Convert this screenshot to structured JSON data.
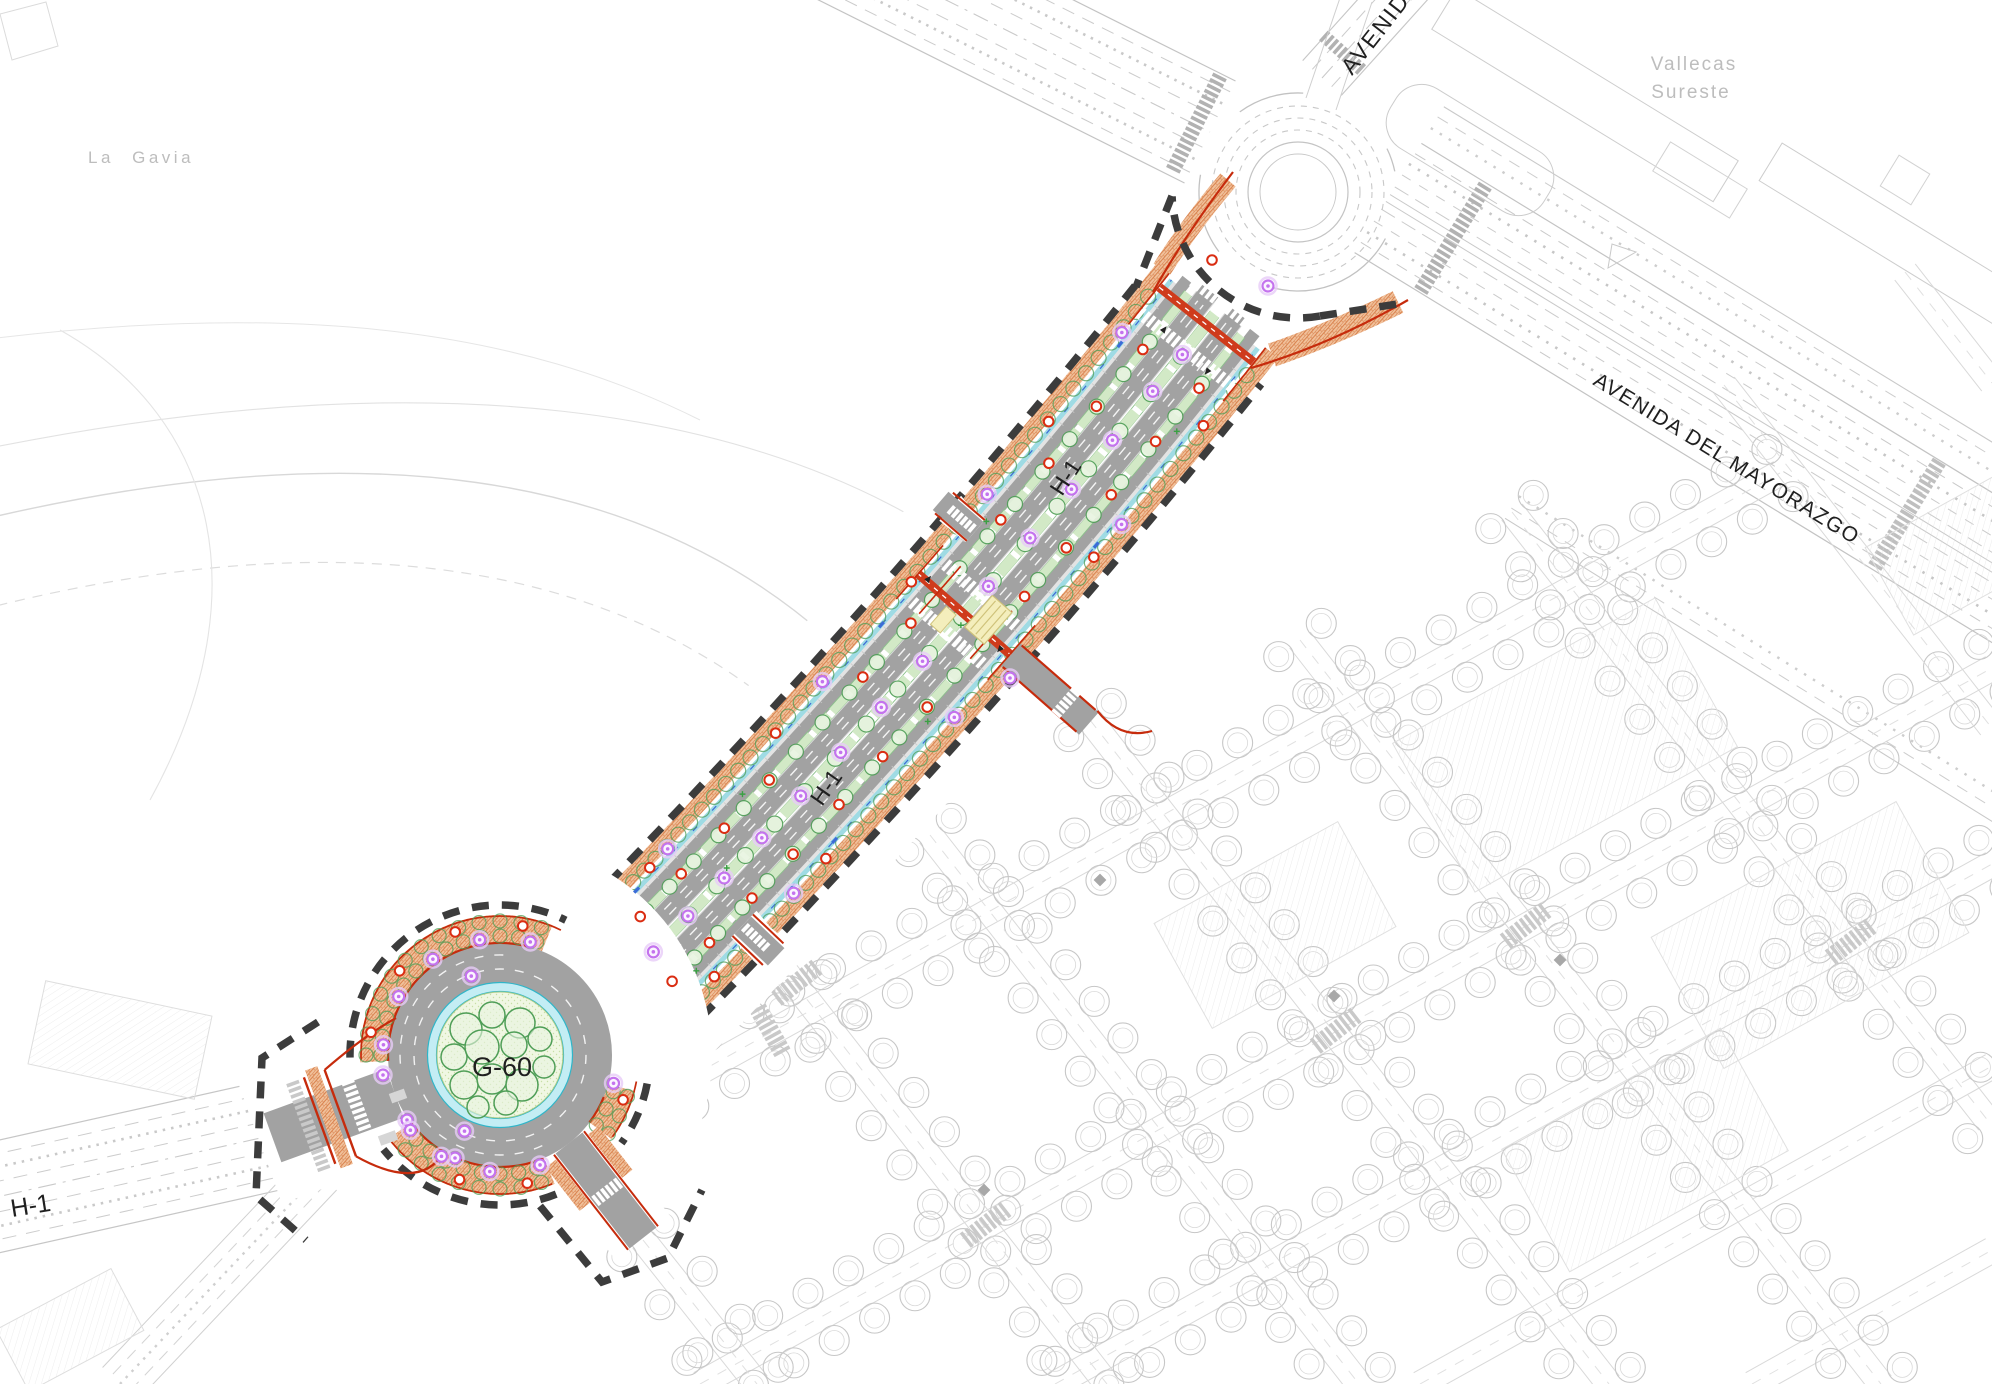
{
  "map": {
    "title": "Urbanization plan - boulevard H-1 with roundabout G-60",
    "region_labels": {
      "la_gavia": "La Gavia",
      "vallecas_line1": "Vallecas",
      "vallecas_line2": "Sureste"
    },
    "road_labels": {
      "avenida_top": "AVENIDA",
      "avenida_mayorazgo": "AVENIDA DEL MAYORAZGO",
      "h1_upper": "H-1",
      "h1_mid": "H-1",
      "h1_west": "H-1",
      "g60_roundabout": "G-60"
    },
    "colors": {
      "road_gray": "#a2a2a2",
      "sidewalk_fill": "#f0c09a",
      "sidewalk_hatch": "#d9834f",
      "median_green": "#d2e9c6",
      "median_edge": "#8cc08c",
      "tree_green": "#4f9e57",
      "tree_fill": "#e8f4e0",
      "island_fill": "#f0f7e3",
      "island_dot": "#c8dfa6",
      "aqua": "#c3edf4",
      "aqua_edge": "#2fb6c9",
      "curb_red": "#c62b0c",
      "crossing_red": "#cf3b1c",
      "bus_yellow": "#f4eebc",
      "bus_yellow_edge": "#cfc27a",
      "lamp_violet": "#c473ee",
      "marker_red": "#da2d12",
      "bike_cyan": "#9fdbe4",
      "bike_blue": "#3c6cd7",
      "boundary": "#3c3c3c",
      "bg_line": "#c7c7c7",
      "bg_line_light": "#d9d9d9",
      "bg_dark": "#b2b2b2",
      "label_gray": "#bdbdbd",
      "label_black": "#1f1f1f"
    }
  }
}
